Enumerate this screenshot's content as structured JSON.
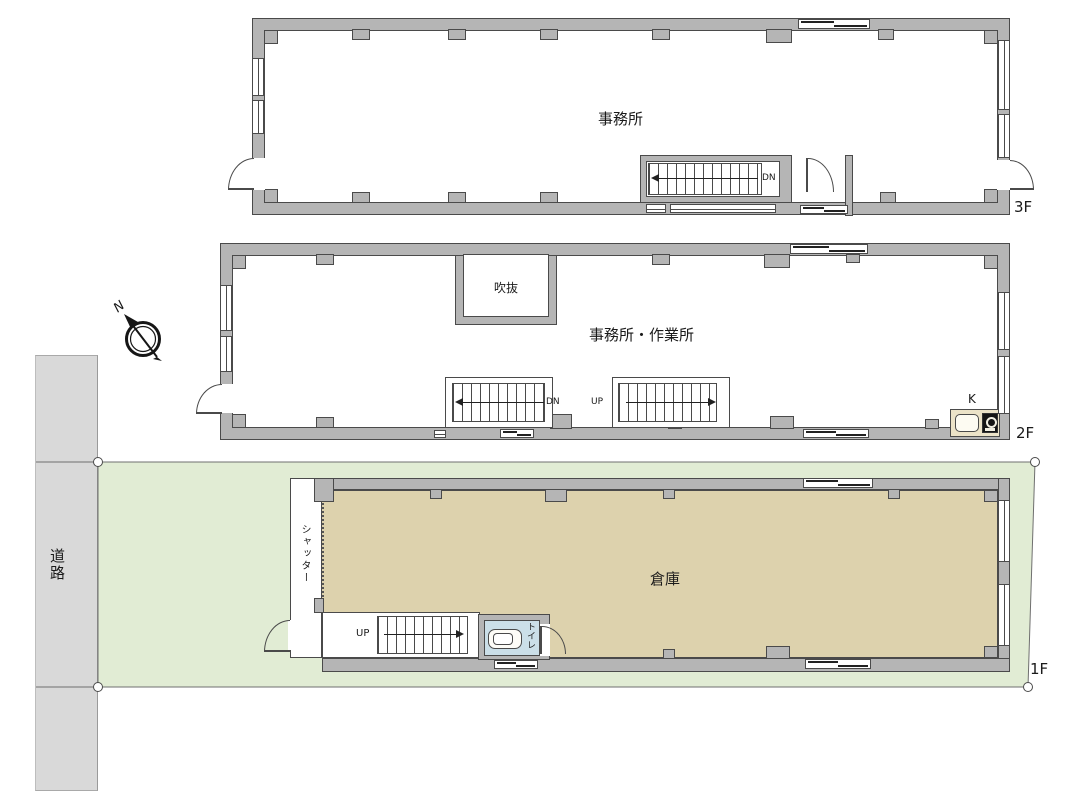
{
  "title": "3-story building floor plan",
  "floors": {
    "f3": {
      "tag": "3F",
      "room": "事務所",
      "stair": "DN"
    },
    "f2": {
      "tag": "2F",
      "room": "事務所・作業所",
      "void": "吹抜",
      "stair_down": "DN",
      "stair_up": "UP",
      "kitchen": "K"
    },
    "f1": {
      "tag": "1F",
      "room": "倉庫",
      "stair": "UP",
      "toilet": "トイレ",
      "shutter": "シャッター"
    }
  },
  "site": {
    "road": "道路"
  },
  "compass": {
    "north": "N"
  },
  "colors": {
    "wall_fill": "#b5b5b5",
    "outline": "#4a4a4a",
    "road_fill": "#d9d9d9",
    "site_fill": "#e1ecd4",
    "warehouse_fill": "#ddd2ad",
    "toilet_fill": "#cbdfe8",
    "kitchen_counter": "#ece3c8"
  }
}
